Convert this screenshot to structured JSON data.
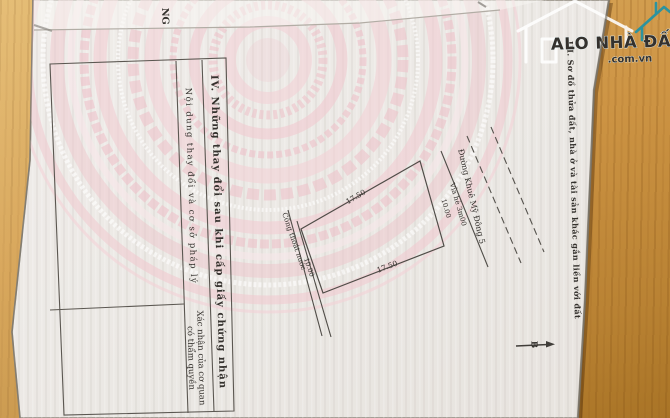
{
  "photo": {
    "description": "photo of a Vietnamese land-use-right certificate page lying on a wooden table",
    "cutoff_fragment_top_left": "NG"
  },
  "watermark": {
    "brand": "ALO NHÀ ĐẤT",
    "domain": ".com.vn",
    "teal": "#1f93a6"
  },
  "section3": {
    "heading": "III. Sơ đồ thửa đất, nhà ở và tài sản khác gắn liền với đất",
    "diagram": {
      "plot": {
        "edge_top": "17.50",
        "edge_bottom": "17.50",
        "edge_right": "10.00",
        "edge_left": "10.00"
      },
      "road_label": "Đường Khuê Mỹ Đông 5",
      "sidewalk_label": "Vỉa hè 3m00",
      "drain_label": "Cống thoát nước",
      "north_label": "B"
    }
  },
  "section4": {
    "heading": "IV. Những thay đổi sau khi cấp giấy chứng nhận",
    "col1": "Nội dung thay đổi và cơ sở pháp lý",
    "col2_line1": "Xác nhận của cơ quan",
    "col2_line2": "có thẩm quyền"
  },
  "colors": {
    "wood": "#cd9444",
    "paper": "#edeae6",
    "emblem_pink": "#eec4cb",
    "ink": "#34312d",
    "line": "#55524e"
  }
}
